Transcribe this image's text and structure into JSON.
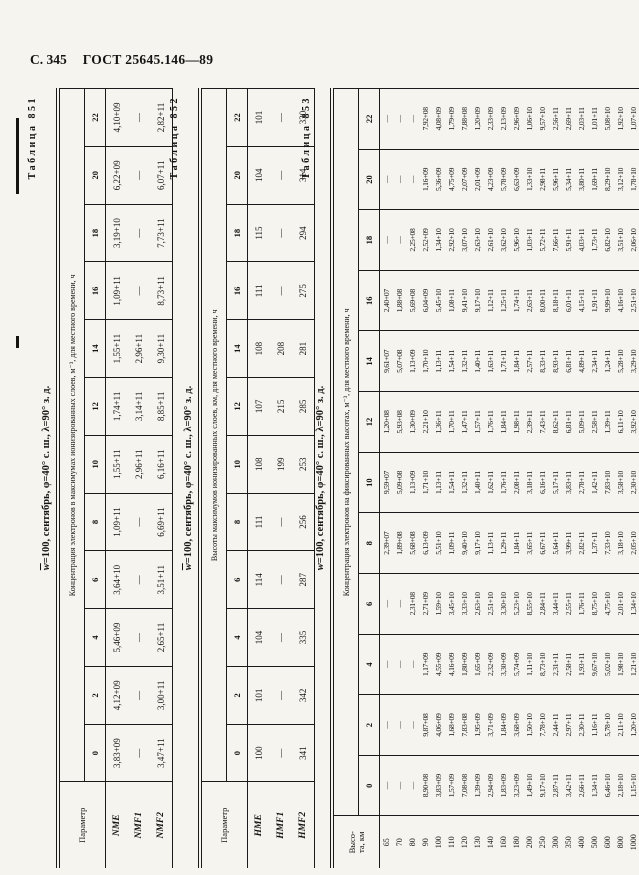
{
  "page": {
    "page_label": "С. 345",
    "doc_number": "ГОСТ 25645.146—89"
  },
  "tables": [
    {
      "caption": "Таблица 851",
      "title_w": "w",
      "title_rest": "=100, сентябрь, φ=40° с. ш., λ=90° з. д.",
      "param_lines": [
        "Параметр"
      ],
      "span_header": "Концентрация электронов в максимумах ионизированных слоев, м⁻³, для местного времени, ч",
      "hours": [
        "0",
        "2",
        "4",
        "6",
        "8",
        "10",
        "12",
        "14",
        "16",
        "18",
        "20",
        "22"
      ],
      "rows": [
        {
          "name": "NME",
          "values": [
            "3,83+09",
            "4,12+09",
            "5,46+09",
            "3,64+10",
            "1,09+11",
            "1,55+11",
            "1,74+11",
            "1,55+11",
            "1,09+11",
            "3,19+10",
            "6,22+09",
            "4,10+09"
          ]
        },
        {
          "name": "NMF1",
          "values": [
            "—",
            "—",
            "—",
            "—",
            "—",
            "2,96+11",
            "3,14+11",
            "2,96+11",
            "—",
            "—",
            "—",
            "—"
          ]
        },
        {
          "name": "NMF2",
          "values": [
            "3,47+11",
            "3,00+11",
            "2,65+11",
            "3,51+11",
            "6,69+11",
            "6,16+11",
            "8,85+11",
            "9,30+11",
            "8,73+11",
            "7,73+11",
            "6,07+11",
            "2,82+11"
          ]
        }
      ]
    },
    {
      "caption": "Таблица 852",
      "title_w": "w",
      "title_rest": "=100, сентябрь, φ=40° с. ш., λ=90° з. д.",
      "param_lines": [
        "Параметр"
      ],
      "span_header": "Высоты максимумов ионизированных слоев, км, для местного времени, ч",
      "hours": [
        "0",
        "2",
        "4",
        "6",
        "8",
        "10",
        "12",
        "14",
        "16",
        "18",
        "20",
        "22"
      ],
      "rows": [
        {
          "name": "HME",
          "values": [
            "100",
            "101",
            "104",
            "114",
            "111",
            "108",
            "107",
            "108",
            "111",
            "115",
            "104",
            "101"
          ]
        },
        {
          "name": "HMF1",
          "values": [
            "—",
            "—",
            "—",
            "—",
            "—",
            "199",
            "215",
            "208",
            "—",
            "—",
            "—",
            "—"
          ]
        },
        {
          "name": "HMF2",
          "values": [
            "341",
            "342",
            "335",
            "287",
            "256",
            "253",
            "285",
            "281",
            "275",
            "294",
            "314",
            "330"
          ]
        }
      ]
    },
    {
      "caption": "Таблица 853",
      "title_w": "w",
      "title_rest": "=100, сентябрь, φ=40° с. ш., λ=90° з. д.",
      "param_lines": [
        "Высо-",
        "та, км"
      ],
      "span_header": "Концентрация электронов на фиксированных высотах, м⁻³, для местного времени, ч",
      "hours": [
        "0",
        "2",
        "4",
        "6",
        "8",
        "10",
        "12",
        "14",
        "16",
        "18",
        "20",
        "22"
      ],
      "rows": [
        {
          "name": "65",
          "values": [
            "—",
            "—",
            "—",
            "—",
            "2,39+07",
            "9,59+07",
            "1,20+08",
            "9,61+07",
            "2,40+07",
            "—",
            "—",
            "—"
          ]
        },
        {
          "name": "70",
          "values": [
            "—",
            "—",
            "—",
            "—",
            "1,89+08",
            "5,09+08",
            "5,93+08",
            "5,07+08",
            "1,88+08",
            "—",
            "—",
            "—"
          ]
        },
        {
          "name": "80",
          "values": [
            "—",
            "—",
            "—",
            "2,31+08",
            "5,68+08",
            "1,13+09",
            "1,30+09",
            "1,13+09",
            "5,69+08",
            "2,25+08",
            "—",
            "—"
          ]
        },
        {
          "name": "90",
          "values": [
            "8,90+08",
            "9,87+08",
            "1,17+09",
            "2,71+09",
            "6,13+09",
            "1,71+10",
            "2,21+10",
            "1,70+10",
            "6,04+09",
            "2,52+09",
            "1,16+09",
            "7,92+08"
          ]
        },
        {
          "name": "100",
          "values": [
            "3,83+09",
            "4,06+09",
            "4,55+09",
            "1,59+10",
            "5,51+10",
            "1,13+11",
            "1,36+11",
            "1,13+11",
            "5,45+10",
            "1,34+10",
            "5,36+09",
            "4,08+09"
          ]
        },
        {
          "name": "110",
          "values": [
            "1,57+09",
            "1,68+09",
            "4,16+09",
            "3,45+10",
            "1,09+11",
            "1,54+11",
            "1,70+11",
            "1,54+11",
            "1,08+11",
            "2,92+10",
            "4,75+09",
            "1,79+09"
          ]
        },
        {
          "name": "120",
          "values": [
            "7,08+08",
            "7,83+08",
            "1,80+09",
            "3,33+10",
            "9,40+10",
            "1,32+11",
            "1,47+11",
            "1,32+11",
            "9,41+10",
            "3,07+10",
            "2,07+09",
            "7,88+08"
          ]
        },
        {
          "name": "130",
          "values": [
            "1,39+09",
            "1,95+09",
            "1,65+09",
            "2,63+10",
            "9,17+10",
            "1,40+11",
            "1,57+11",
            "1,40+11",
            "9,17+10",
            "2,63+10",
            "2,01+09",
            "1,20+09"
          ]
        },
        {
          "name": "140",
          "values": [
            "2,94+09",
            "3,71+09",
            "2,32+09",
            "2,51+10",
            "1,13+11",
            "1,62+11",
            "1,76+11",
            "1,63+11",
            "1,12+11",
            "2,61+10",
            "4,23+09",
            "2,33+09"
          ]
        },
        {
          "name": "160",
          "values": [
            "1,83+09",
            "1,84+09",
            "3,30+09",
            "3,30+10",
            "1,29+11",
            "1,76+11",
            "1,84+11",
            "1,71+11",
            "1,25+11",
            "3,62+10",
            "5,78+09",
            "2,13+09"
          ]
        },
        {
          "name": "180",
          "values": [
            "3,23+09",
            "3,68+09",
            "5,74+09",
            "5,23+10",
            "1,84+11",
            "2,08+11",
            "1,98+11",
            "1,84+11",
            "1,74+11",
            "5,96+10",
            "6,63+09",
            "2,96+09"
          ]
        },
        {
          "name": "200",
          "values": [
            "1,49+10",
            "1,50+10",
            "1,11+10",
            "8,55+10",
            "3,65+11",
            "3,18+11",
            "2,39+11",
            "2,57+11",
            "2,63+11",
            "1,03+11",
            "1,33+10",
            "1,06+10"
          ]
        },
        {
          "name": "250",
          "values": [
            "9,17+10",
            "7,78+10",
            "8,73+10",
            "2,84+11",
            "6,67+11",
            "6,16+11",
            "7,43+11",
            "8,33+11",
            "8,00+11",
            "5,72+11",
            "2,98+11",
            "9,57+10"
          ]
        },
        {
          "name": "300",
          "values": [
            "2,87+11",
            "2,44+11",
            "2,31+11",
            "3,44+11",
            "5,64+11",
            "5,17+11",
            "8,62+11",
            "8,93+11",
            "8,18+11",
            "7,66+11",
            "5,96+11",
            "2,56+11"
          ]
        },
        {
          "name": "350",
          "values": [
            "3,42+11",
            "2,97+11",
            "2,58+11",
            "2,55+11",
            "3,99+11",
            "3,83+11",
            "6,81+11",
            "6,81+11",
            "6,01+11",
            "5,91+11",
            "5,34+11",
            "2,69+11"
          ]
        },
        {
          "name": "400",
          "values": [
            "2,66+11",
            "2,30+11",
            "1,93+11",
            "1,76+11",
            "2,82+11",
            "2,78+11",
            "5,09+11",
            "4,89+11",
            "4,15+11",
            "4,03+11",
            "3,80+11",
            "2,03+11"
          ]
        },
        {
          "name": "500",
          "values": [
            "1,34+11",
            "1,16+11",
            "9,67+10",
            "8,75+10",
            "1,37+11",
            "1,42+11",
            "2,58+11",
            "2,34+11",
            "1,91+11",
            "1,73+11",
            "1,69+11",
            "1,01+11"
          ]
        },
        {
          "name": "600",
          "values": [
            "6,46+10",
            "5,78+10",
            "5,02+10",
            "4,75+10",
            "7,33+10",
            "7,83+10",
            "1,39+11",
            "1,24+11",
            "9,99+10",
            "6,82+10",
            "8,29+10",
            "5,08+10"
          ]
        },
        {
          "name": "800",
          "values": [
            "2,18+10",
            "2,11+10",
            "1,98+10",
            "2,01+10",
            "3,18+10",
            "3,58+10",
            "6,11+10",
            "5,28+10",
            "4,16+10",
            "3,51+10",
            "3,12+10",
            "1,92+10"
          ]
        },
        {
          "name": "1000",
          "values": [
            "1,15+10",
            "1,20+10",
            "1,21+10",
            "1,34+10",
            "2,05+10",
            "2,30+10",
            "3,92+10",
            "3,29+10",
            "2,51+10",
            "2,06+10",
            "1,78+10",
            "1,07+10"
          ]
        }
      ]
    }
  ]
}
